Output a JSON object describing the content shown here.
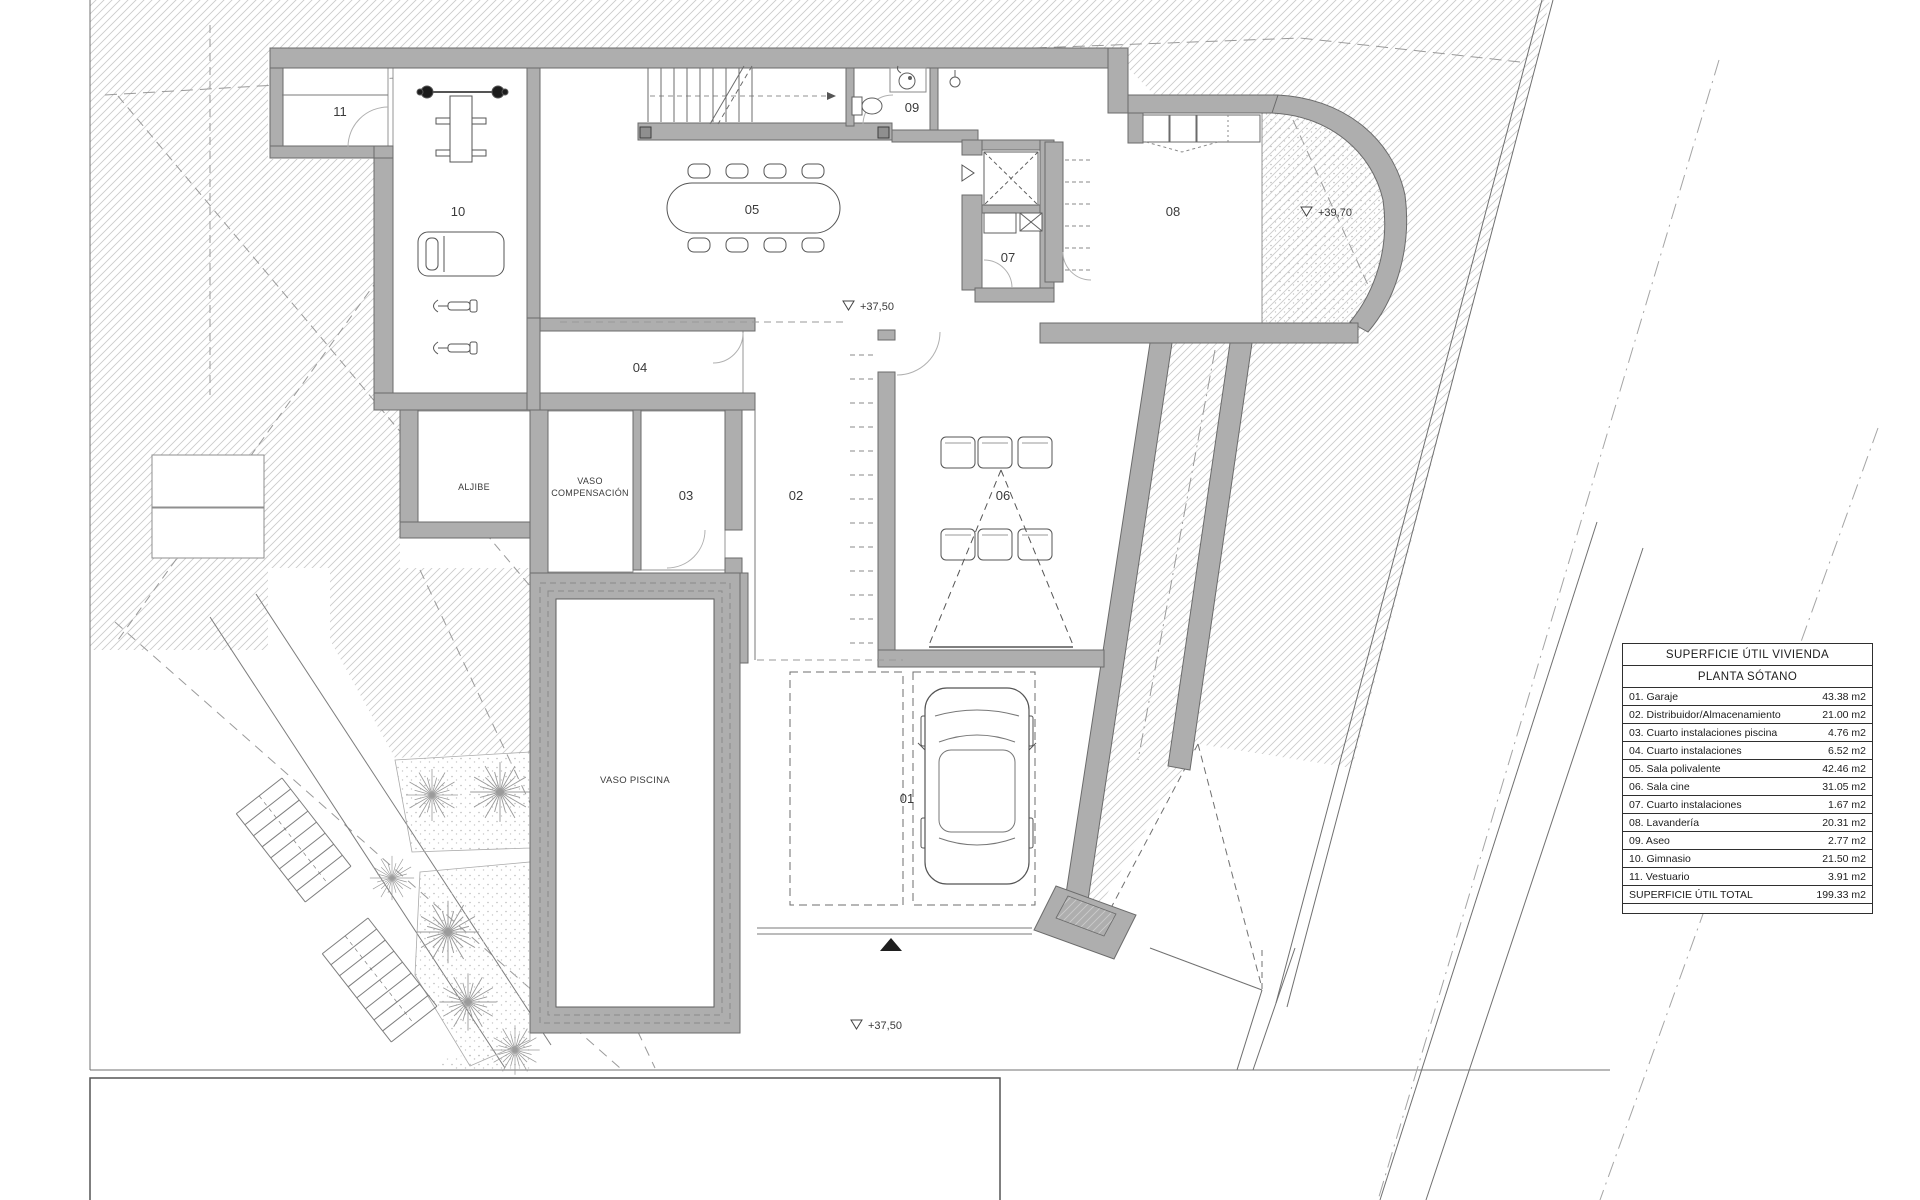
{
  "table": {
    "title": "SUPERFICIE ÚTIL VIVIENDA",
    "subtitle": "PLANTA SÓTANO",
    "rows": [
      {
        "label": "01. Garaje",
        "value": "43.38 m2"
      },
      {
        "label": "02. Distribuidor/Almacenamiento",
        "value": "21.00 m2"
      },
      {
        "label": "03. Cuarto instalaciones piscina",
        "value": "4.76 m2"
      },
      {
        "label": "04. Cuarto instalaciones",
        "value": "6.52 m2"
      },
      {
        "label": "05. Sala polivalente",
        "value": "42.46 m2"
      },
      {
        "label": "06. Sala cine",
        "value": "31.05 m2"
      },
      {
        "label": "07. Cuarto instalaciones",
        "value": "1.67 m2"
      },
      {
        "label": "08. Lavandería",
        "value": "20.31 m2"
      },
      {
        "label": "09. Aseo",
        "value": "2.77 m2"
      },
      {
        "label": "10. Gimnasio",
        "value": "21.50 m2"
      },
      {
        "label": "11. Vestuario",
        "value": "3.91 m2"
      }
    ],
    "total_label": "SUPERFICIE ÚTIL TOTAL",
    "total_value": "199.33 m2"
  },
  "plan": {
    "rooms": {
      "r01": "01",
      "r02": "02",
      "r03": "03",
      "r04": "04",
      "r05": "05",
      "r06": "06",
      "r07": "07",
      "r08": "08",
      "r09": "09",
      "r10": "10",
      "r11": "11"
    },
    "labels": {
      "aljibe": "ALJIBE",
      "vaso_line1": "VASO",
      "vaso_line2": "COMPENSACIÓN",
      "vaso_piscina": "VASO PISCINA"
    },
    "levels": {
      "main": "+37,50",
      "terrace": "+39,70",
      "street": "+37,50"
    }
  }
}
